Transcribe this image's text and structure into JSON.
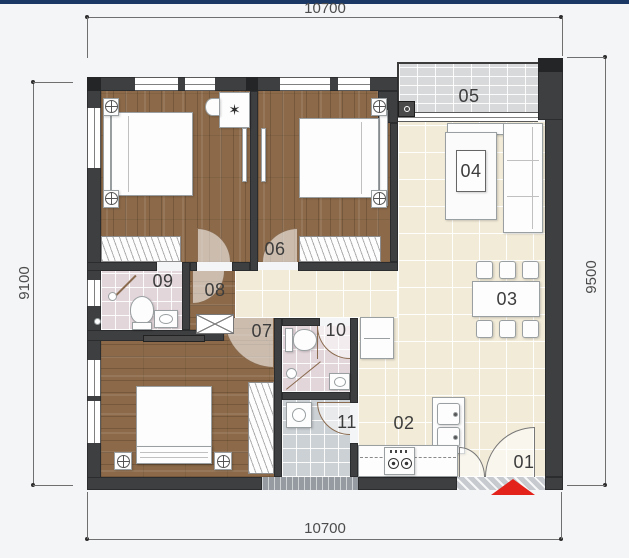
{
  "page": {
    "top_bar_color": "#1a3863",
    "background": "#f4f5f7"
  },
  "dimensions": {
    "top": "10700",
    "bottom": "10700",
    "left": "9100",
    "right": "9500"
  },
  "rooms": {
    "r01": {
      "label": "01"
    },
    "r02": {
      "label": "02"
    },
    "r03": {
      "label": "03"
    },
    "r04": {
      "label": "04"
    },
    "r05": {
      "label": "05"
    },
    "r06": {
      "label": "06"
    },
    "r07": {
      "label": "07"
    },
    "r08": {
      "label": "08"
    },
    "r09": {
      "label": "09"
    },
    "r10": {
      "label": "10"
    },
    "r11": {
      "label": "11"
    }
  },
  "icons": {
    "star_plant": "✶"
  },
  "colors": {
    "wall": "#3e3f41",
    "wood_floor": "#8c6a49",
    "cream_tile": "#f2ebd8",
    "pink_tile": "#e3d6db",
    "gray_tile": "#ccd1d6",
    "balcony_tile": "#d7d9db",
    "entry_arrow_red": "#e3231b",
    "dimension_text": "#4c4c4c"
  }
}
